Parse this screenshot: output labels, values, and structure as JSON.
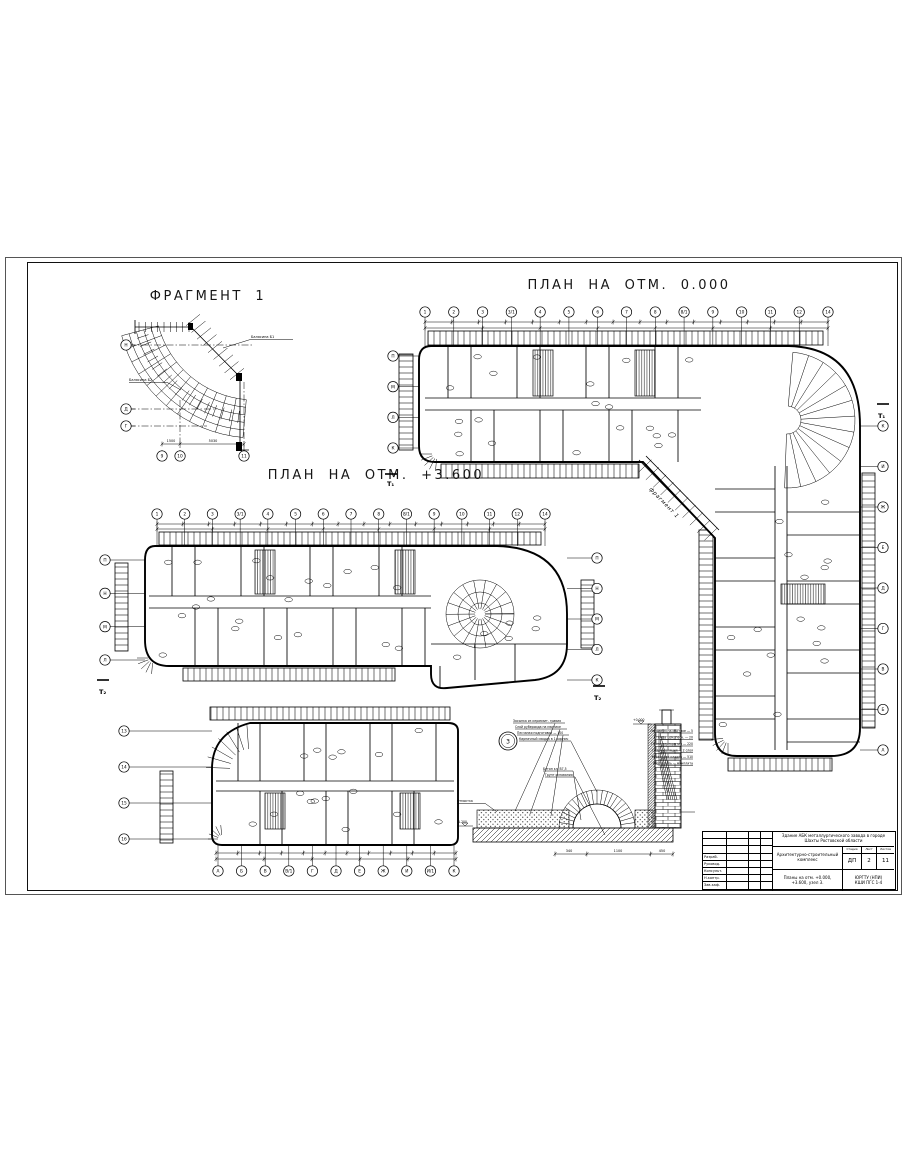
{
  "fragment1": {
    "title": "ФРАГМЕНТ 1",
    "left_axes": [
      "Н",
      "Д",
      "Г"
    ],
    "bottom_axes": [
      "9",
      "10",
      "11"
    ],
    "callout_top": "Балясина Б1",
    "callout_left": "Балясина Б2",
    "dims": [
      "1500",
      "5030"
    ]
  },
  "plan0": {
    "title": "ПЛАН НА ОТМ. 0.000",
    "top_axes": [
      "1",
      "2",
      "3",
      "3/1",
      "4",
      "5",
      "6",
      "7",
      "8",
      "8/1",
      "9",
      "10",
      "11",
      "12",
      "14"
    ],
    "left_axes": [
      "П",
      "М",
      "Л",
      "К"
    ],
    "right_axes": [
      "К",
      "И",
      "Ж",
      "Е",
      "Д",
      "Г",
      "В",
      "Б",
      "А"
    ],
    "corner_label": "фрагмент 1",
    "section_left": "Т₁",
    "section_right": "Т₁"
  },
  "plan36": {
    "title": "ПЛАН НА ОТМ. +3.600",
    "top_axes": [
      "1",
      "2",
      "3",
      "3/1",
      "4",
      "5",
      "6",
      "7",
      "8",
      "8/1",
      "9",
      "10",
      "11",
      "12",
      "14"
    ],
    "left_axes": [
      "П",
      "Н",
      "М",
      "Л"
    ],
    "right_axes": [
      "П",
      "Н",
      "М",
      "Л",
      "К"
    ],
    "section_left": "Т₂",
    "section_right": "Т₂"
  },
  "plan_lower": {
    "bottom_axes": [
      "А",
      "Б",
      "В",
      "В/1",
      "Г",
      "Д",
      "Е",
      "Ж",
      "И",
      "И/1",
      "К"
    ],
    "left_axes": [
      "13",
      "14",
      "15",
      "16"
    ]
  },
  "detail": {
    "node_number": "3",
    "left_labels": [
      "Засыпка из керамзит. гравия",
      "Слой рубероида на мастике",
      "Песчаная подготовка — 100",
      "Кирпичный сводик в 1 кирпич"
    ],
    "mid_labels": [
      "Бетон кл. В7,5",
      "Грунт основания"
    ],
    "right_labels": [
      "Линолеум на мастике — 5",
      "Стяжка цем.-песч. — 20",
      "Плита перекрытия — 220",
      "Гидроизоляция — 2 слоя",
      "Кирпичная кладка — 510",
      "Утеплитель — минплита"
    ],
    "left_note": "Отмостка",
    "elev_top": "+0.000",
    "elev_left": "-1.200",
    "dims": [
      "340",
      "1100",
      "450"
    ]
  },
  "titleblock": {
    "project_line": "Здание АБК металлургического завода в городе Шахты Ростовской области",
    "section_line": "Архитектурно-строительный комплекс",
    "sheet_title": "Планы на отм. +0.000, +3.600, узел 3.",
    "stage_label": "Стадия",
    "list_label": "Лист",
    "lists_label": "Листов",
    "stage": "ДП",
    "list": "2",
    "lists": "11",
    "org": "ЮРГТУ (НПИ)",
    "group": "КШИ ПГС 1-4",
    "sign_rows": [
      "Разраб.",
      "Руковод.",
      "Консульт.",
      "Н.контр.",
      "Зав.каф."
    ]
  }
}
